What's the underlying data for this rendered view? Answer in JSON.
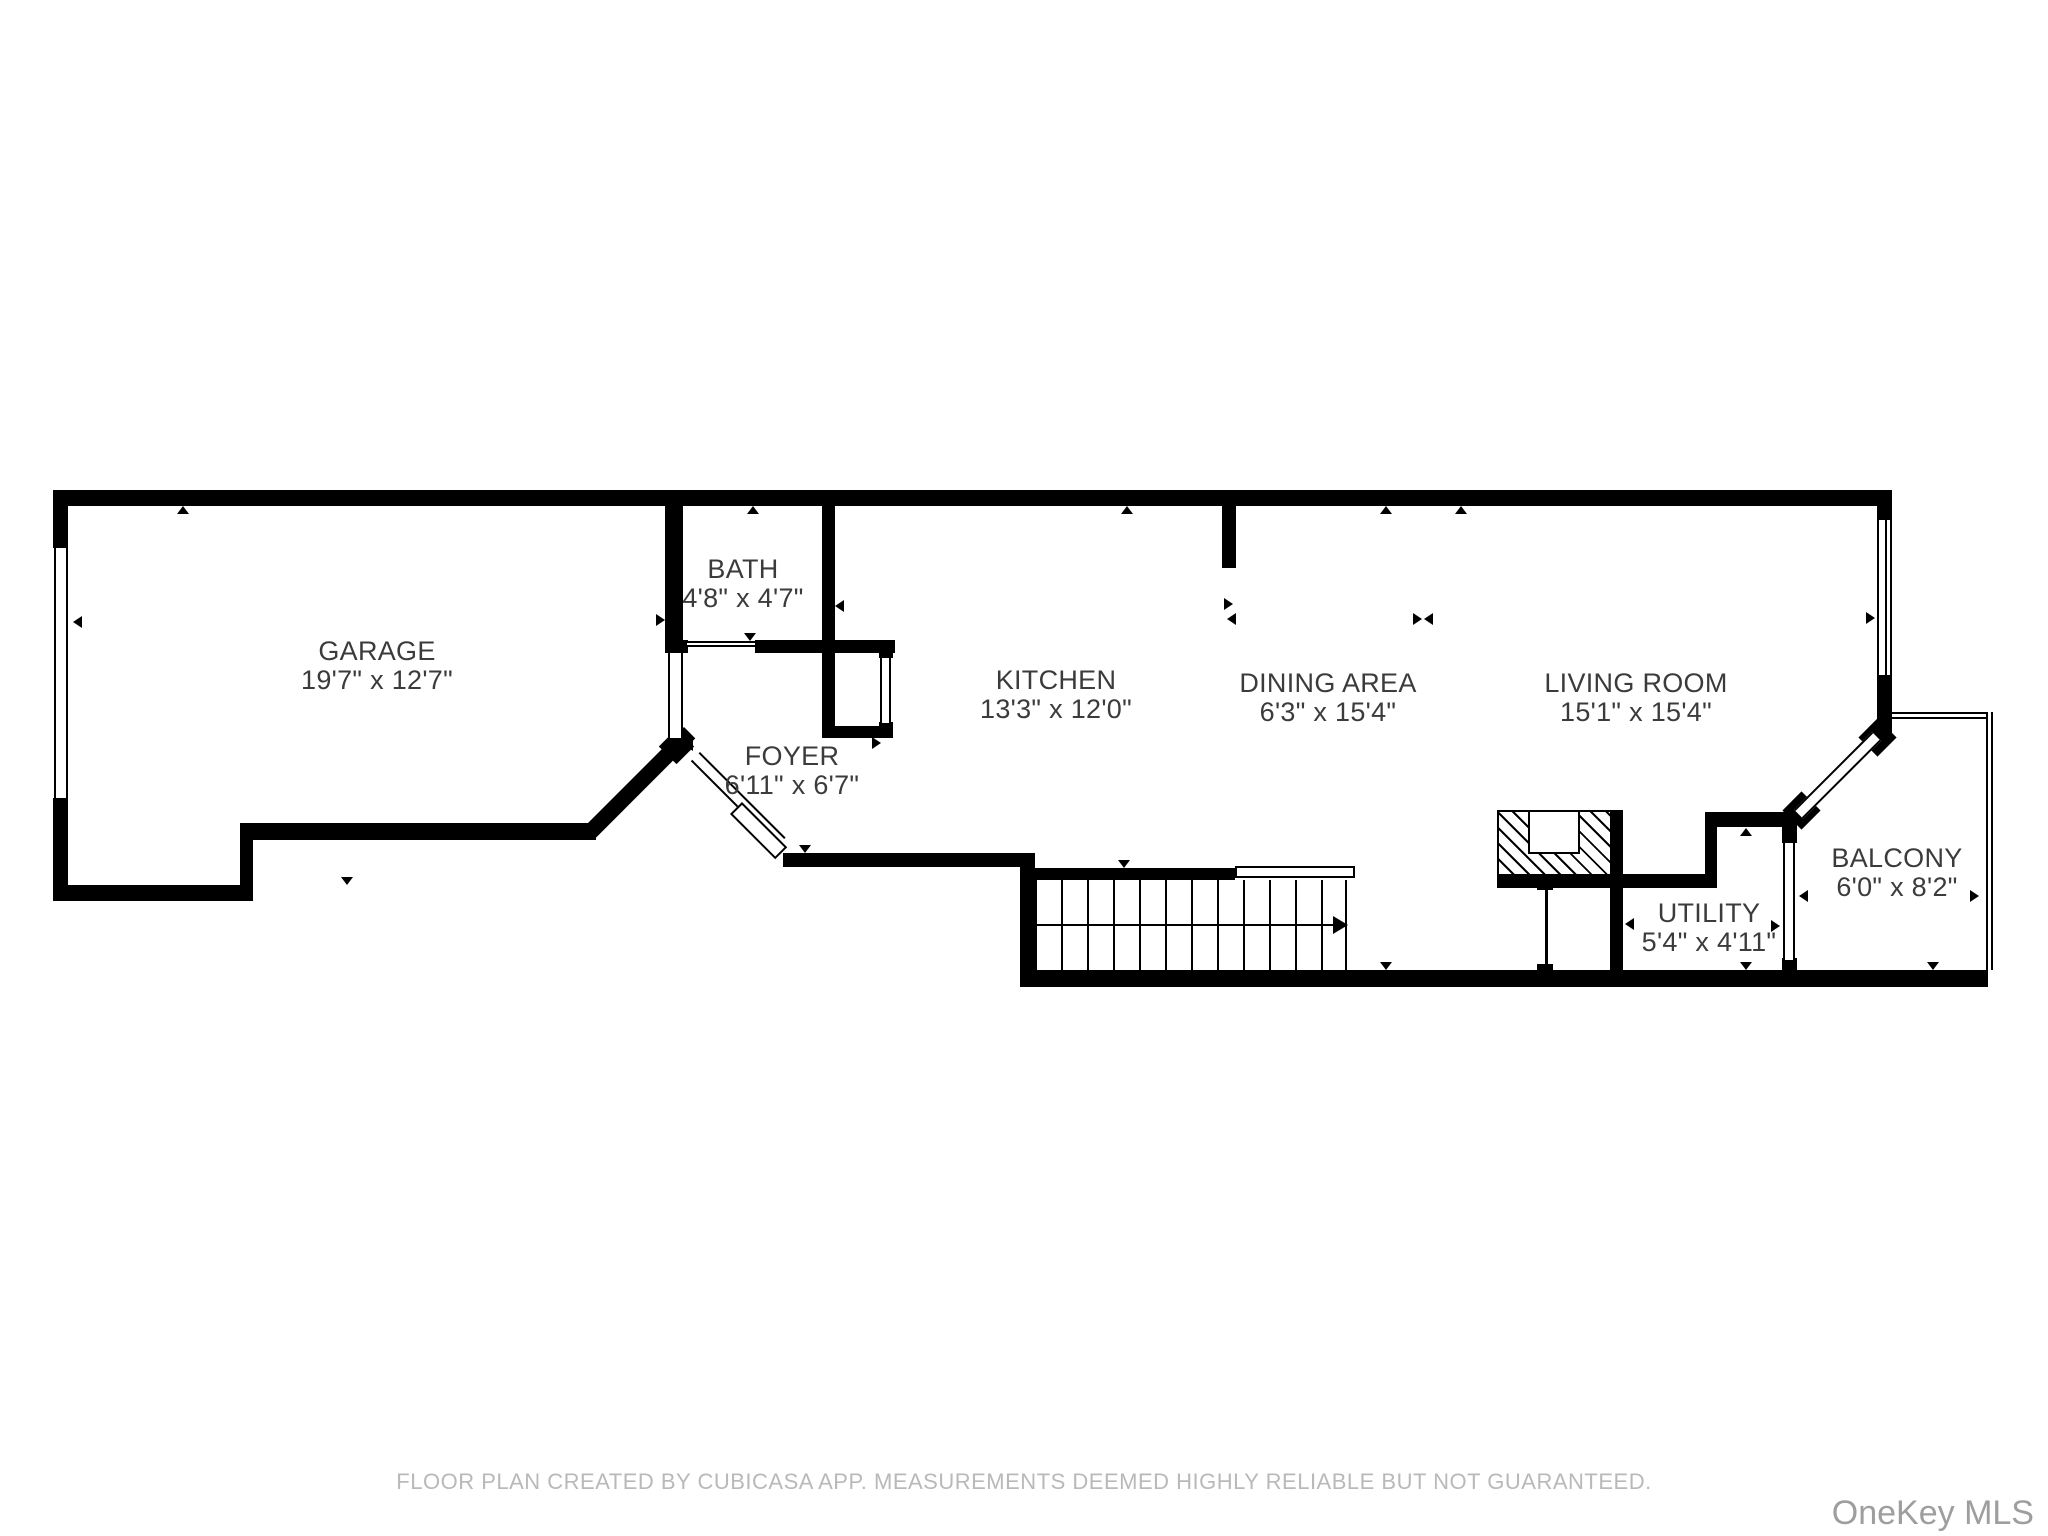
{
  "plan": {
    "rooms": [
      {
        "id": "garage",
        "name": "GARAGE",
        "dims": "19'7\" x 12'7\""
      },
      {
        "id": "bath",
        "name": "BATH",
        "dims": "4'8\" x 4'7\""
      },
      {
        "id": "foyer",
        "name": "FOYER",
        "dims": "6'11\" x 6'7\""
      },
      {
        "id": "kitchen",
        "name": "KITCHEN",
        "dims": "13'3\" x 12'0\""
      },
      {
        "id": "dining",
        "name": "DINING AREA",
        "dims": "6'3\" x 15'4\""
      },
      {
        "id": "living",
        "name": "LIVING ROOM",
        "dims": "15'1\" x 15'4\""
      },
      {
        "id": "utility",
        "name": "UTILITY",
        "dims": "5'4\" x 4'11\""
      },
      {
        "id": "balcony",
        "name": "BALCONY",
        "dims": "6'0\" x 8'2\""
      }
    ],
    "colors": {
      "wall": "#000000",
      "room_label": "#3b3b3b",
      "footer_text": "#b9b9b9",
      "watermark": "#9e9e9e",
      "background": "#ffffff"
    }
  },
  "footer": {
    "disclaimer": "FLOOR PLAN CREATED BY CUBICASA APP. MEASUREMENTS DEEMED HIGHLY RELIABLE BUT NOT GUARANTEED."
  },
  "watermark": {
    "text": "OneKey MLS"
  }
}
